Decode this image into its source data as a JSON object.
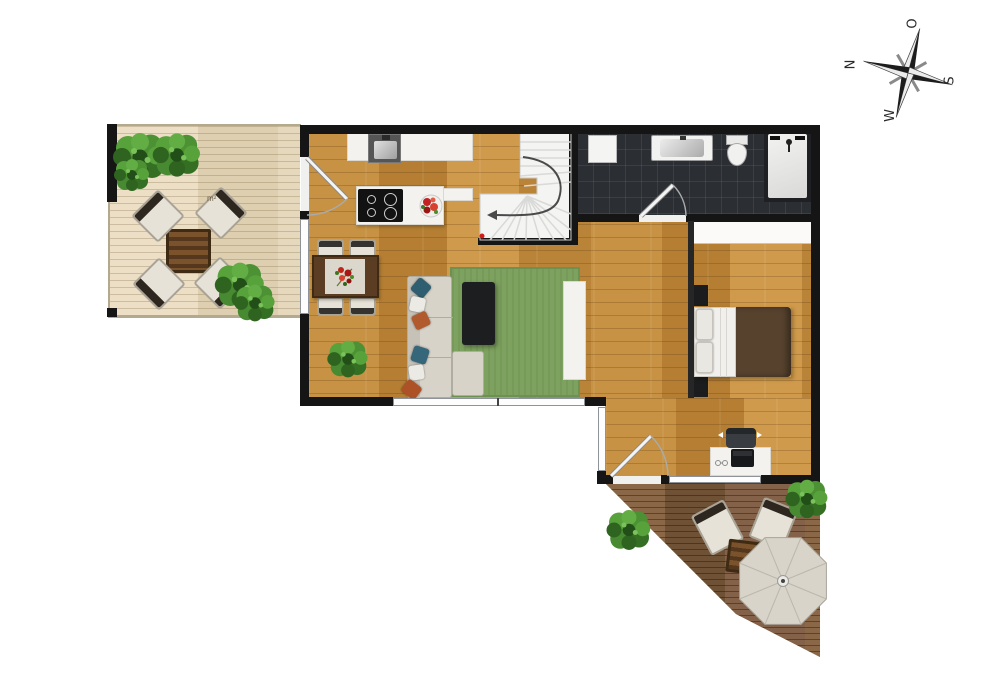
{
  "compass": {
    "north": "N",
    "east": "O",
    "south": "S",
    "west": "W"
  },
  "labels": {
    "terrace_area": "m²"
  },
  "palette": {
    "wall": "#151515",
    "wood_floor": "#bf8a3d",
    "deck_light": "#e7dbc1",
    "deck_dark": "#7f5f40",
    "bathroom_tile": "#2b2e33",
    "rug_green": "#7da15e",
    "stair_white": "#f4f4f3",
    "sofa_beige": "#d7d3c9",
    "bed_blanket_brown": "#57422e",
    "pillow_teal": "#2f5e70",
    "pillow_orange": "#b05a2e",
    "umbrella_cream": "#d9d4c9",
    "plant_green": "#3f7d2c",
    "flower_red": "#c32222",
    "stair_arrow": "#4a4a4a"
  }
}
